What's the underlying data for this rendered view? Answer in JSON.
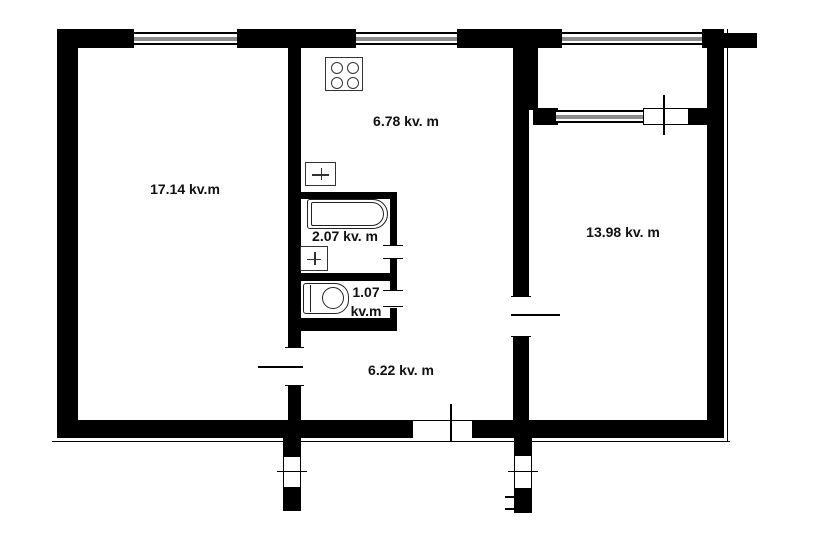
{
  "plan": {
    "type": "apartment-floor-plan",
    "area_unit": "kv.m",
    "rooms": {
      "living": {
        "name": "living-room",
        "area_label": "17.14 kv.m"
      },
      "kitchen": {
        "name": "kitchen",
        "area_label": "6.78 kv. m"
      },
      "bathroom": {
        "name": "bathroom",
        "area_label": "2.07 kv. m"
      },
      "toilet": {
        "name": "toilet",
        "area_value": "1.07",
        "area_unit": "kv.m"
      },
      "bedroom": {
        "name": "bedroom",
        "area_label": "13.98 kv. m"
      },
      "hallway": {
        "name": "hallway",
        "area_label": "6.22 kv. m"
      }
    },
    "fixtures": [
      {
        "icon": "stove-icon",
        "room": "kitchen"
      },
      {
        "icon": "sink-icon",
        "room": "kitchen"
      },
      {
        "icon": "bathtub-icon",
        "room": "bathroom"
      },
      {
        "icon": "sink-icon",
        "room": "bathroom"
      },
      {
        "icon": "toilet-icon",
        "room": "toilet"
      }
    ],
    "openings": [
      "window-living",
      "window-kitchen",
      "window-loggia",
      "window-bedroom",
      "balcony-door",
      "entry-door",
      "living-room-door",
      "bedroom-door",
      "bathroom-door",
      "toilet-door"
    ],
    "colors": {
      "wall": "#000000",
      "background": "#ffffff",
      "window_glass": "#8c8c8c",
      "label_text": "#111111"
    }
  }
}
